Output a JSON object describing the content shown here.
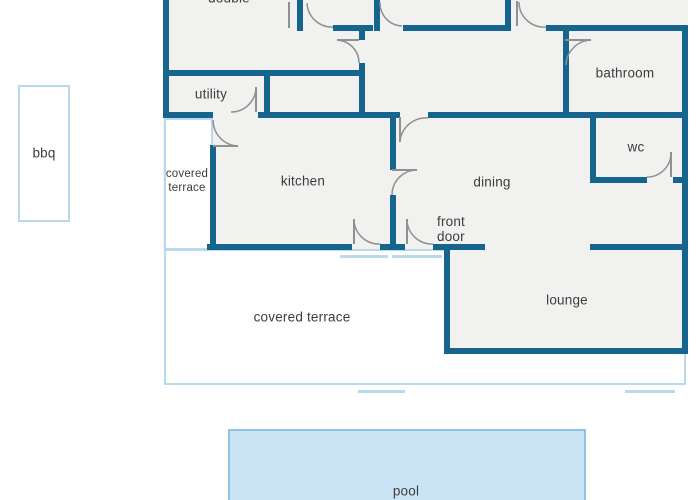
{
  "title": "house floor plan",
  "labels": {
    "double": "double",
    "utility": "utility",
    "bathroom": "bathroom",
    "wc": "wc",
    "kitchen": "kitchen",
    "dining": "dining",
    "front_door": "front door",
    "lounge": "lounge",
    "covered_terrace_small": "covered terrace",
    "covered_terrace_main": "covered terrace",
    "bbq": "bbq",
    "pool": "pool"
  },
  "colors": {
    "wall": "#15658f",
    "outline_light": "#b9d9ec",
    "room_fill": "#f1f2f0",
    "pool_fill": "#cbe4f5",
    "pool_border": "#91c3e2",
    "door": "#909090",
    "label": "#3c3c3c"
  }
}
